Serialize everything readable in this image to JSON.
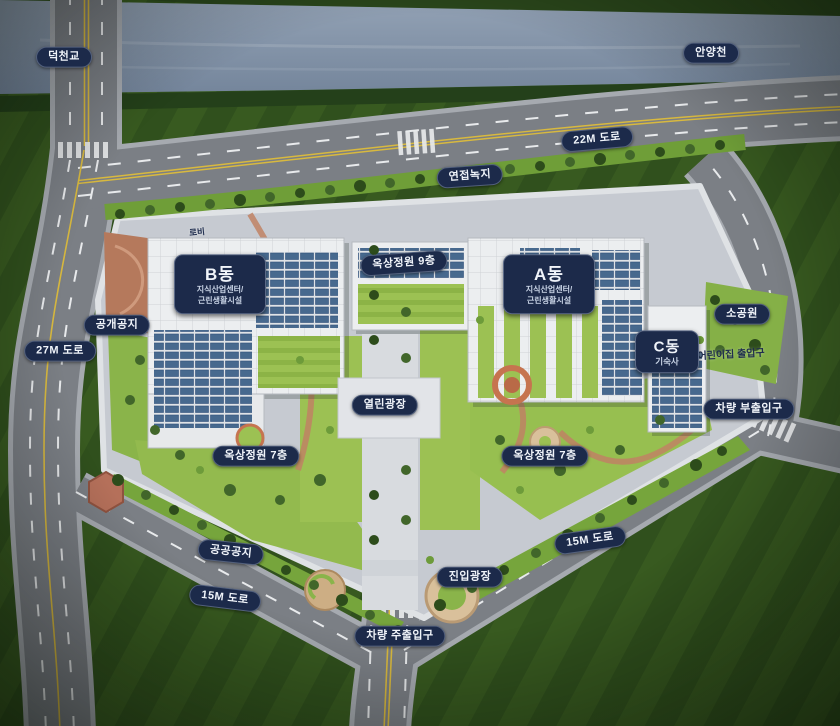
{
  "theme": {
    "label_bg": "#1c2a4a",
    "label_text": "#f0f4fa",
    "water_color": "#8494a9",
    "road_color": "#7b7f85",
    "site_paving": "#c6cad1",
    "garden_green": "#9cc153",
    "solar_panel_blue": "#47698e",
    "terracotta": "#b5795c"
  },
  "labels": {
    "deokcheon_bridge": "덕천교",
    "anyangcheon": "안양천",
    "road_22m": "22M 도로",
    "road_27m": "27M 도로",
    "road_15m": "15M 도로",
    "adjacent_green": "연접녹지",
    "lobby": "로비",
    "rooftop_garden_9f": "옥상정원 9층",
    "rooftop_garden_7f": "옥상정원 7층",
    "small_park": "소공원",
    "daycare_entrance": "어린이집 출입구",
    "vehicle_sub_entrance": "차량 부출입구",
    "vehicle_main_entrance": "차량 주출입구",
    "public_open_space": "공개공지",
    "public_space": "공공공지",
    "open_plaza": "열린광장",
    "entry_plaza": "진입광장"
  },
  "buildings": {
    "a": {
      "name": "A동",
      "desc1": "지식산업센터/",
      "desc2": "근린생활시설"
    },
    "b": {
      "name": "B동",
      "desc1": "지식산업센터/",
      "desc2": "근린생활시설"
    },
    "c": {
      "name": "C동",
      "desc1": "기숙사"
    }
  }
}
